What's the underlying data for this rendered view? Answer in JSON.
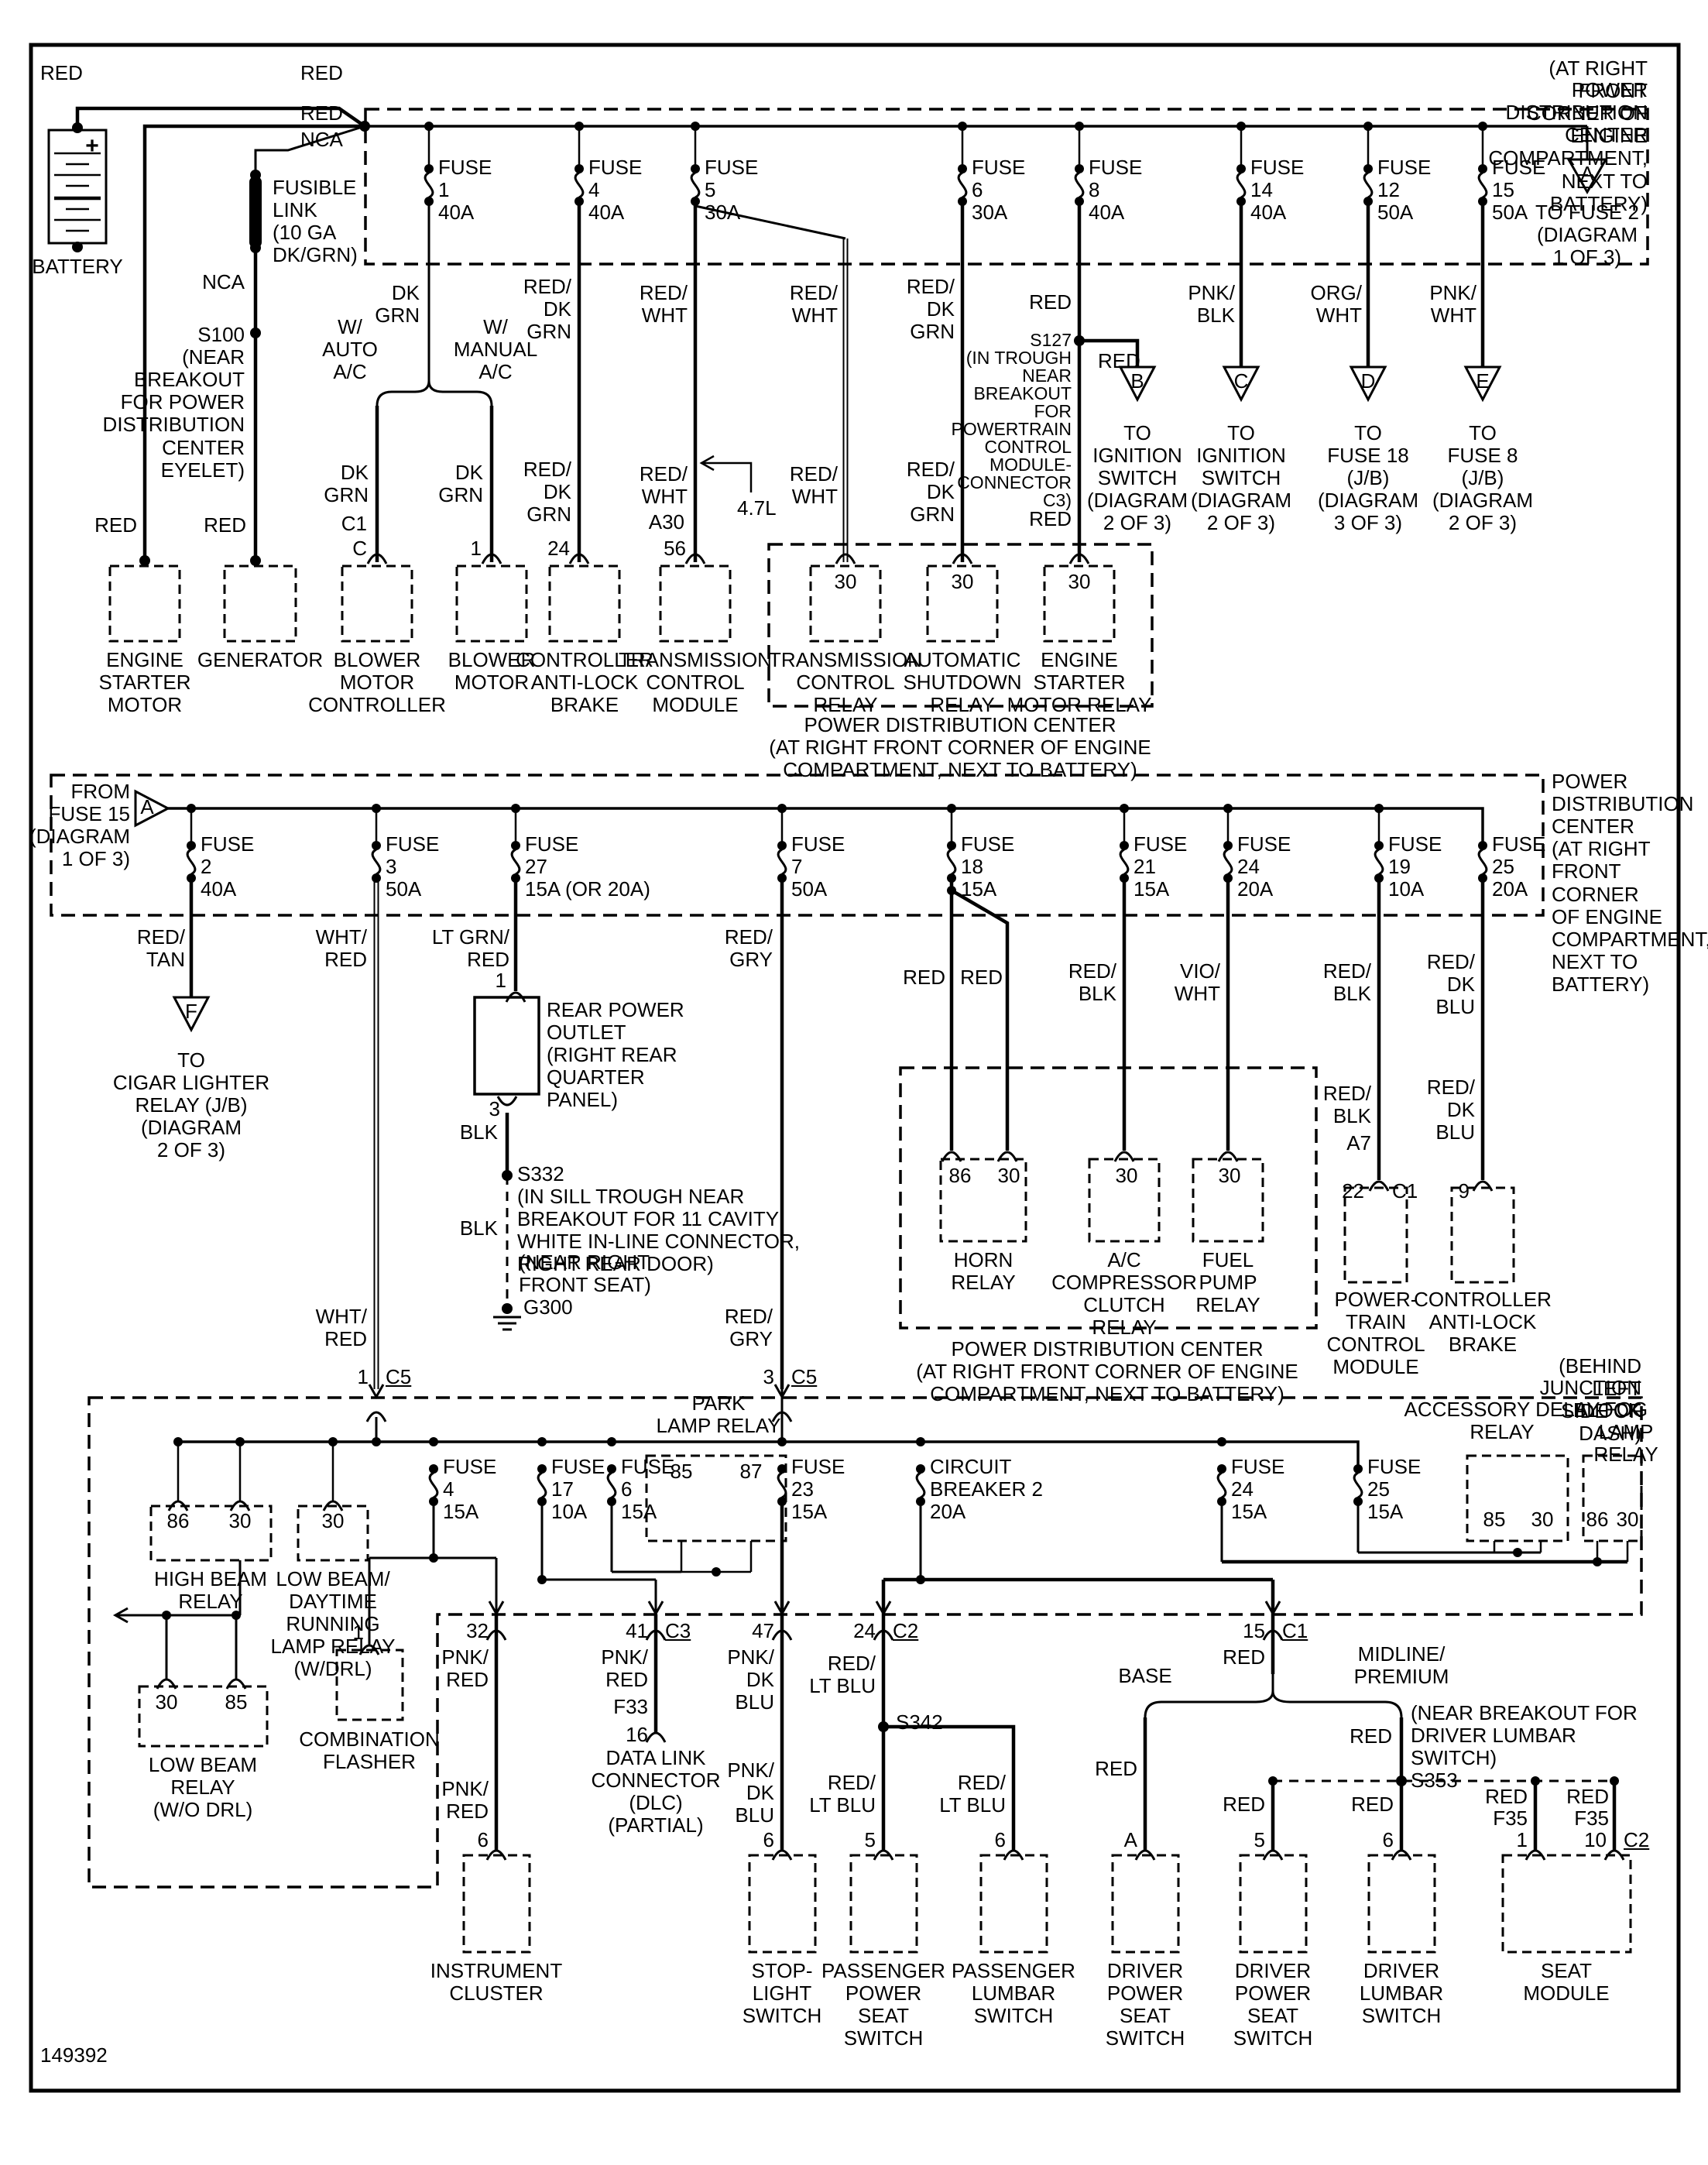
{
  "doc": {
    "id": "149392"
  },
  "s1": {
    "loc": "(AT RIGHT FRONT CORNER OF ENGINE COMPARTMENT, NEXT TO BATTERY)",
    "title": "POWER DISTRIBUTION CENTER",
    "red": "RED",
    "nca": "NCA",
    "battery": "BATTERY",
    "plus": "+",
    "fusible": "FUSIBLE\nLINK\n(10 GA\nDK/GRN)",
    "s100": "S100\n(NEAR\nBREAKOUT\nFOR POWER\nDISTRIBUTION\nCENTER\nEYELET)",
    "fuses": [
      "FUSE\n1\n40A",
      "FUSE\n4\n40A",
      "FUSE\n5\n30A",
      "FUSE\n6\n30A",
      "FUSE\n8\n40A",
      "FUSE\n14\n40A",
      "FUSE\n12\n50A",
      "FUSE\n15\n50A"
    ],
    "tri_a": "A",
    "to_fuse2": "TO FUSE 2\n(DIAGRAM\n1 OF 3)",
    "dkgrn": "DK\nGRN",
    "w_auto": "W/\nAUTO\nA/C",
    "w_manual": "W/\nMANUAL\nA/C",
    "c1": "C1",
    "pin_c": "C",
    "pin_1": "1",
    "reddkgrn": "RED/\nDK\nGRN",
    "pin_24": "24",
    "redwht": "RED/\nWHT",
    "a30": "A30",
    "pin_56": "56",
    "l47": "4.7L",
    "s127": "S127\n(IN TROUGH\nNEAR\nBREAKOUT\nFOR\nPOWERTRAIN\nCONTROL\nMODULE-\nCONNECTOR\nC3)",
    "pnkblk": "PNK/\nBLK",
    "orgwht": "ORG/\nWHT",
    "pnkwht": "PNK/\nWHT",
    "tri_b": "B",
    "tri_c": "C",
    "tri_d": "D",
    "tri_e": "E",
    "cap_ign": "TO\nIGNITION\nSWITCH\n(DIAGRAM\n2 OF 3)",
    "cap_d": "TO\nFUSE 18\n(J/B)\n(DIAGRAM\n3 OF 3)",
    "cap_e": "TO\nFUSE 8\n(J/B)\n(DIAGRAM\n2 OF 3)",
    "p30": "30",
    "c_esm": "ENGINE\nSTARTER\nMOTOR",
    "c_gen": "GENERATOR",
    "c_bmc": "BLOWER\nMOTOR\nCONTROLLER",
    "c_bm": "BLOWER\nMOTOR",
    "c_calb": "CONTROLLER\nANTI-LOCK\nBRAKE",
    "c_tcm": "TRANSMISSION\nCONTROL\nMODULE",
    "c_tcr": "TRANSMISSION\nCONTROL\nRELAY",
    "c_asr": "AUTOMATIC\nSHUTDOWN\nRELAY",
    "c_esmr": "ENGINE\nSTARTER\nMOTOR RELAY",
    "pdc2cap": "POWER DISTRIBUTION CENTER\n(AT RIGHT FRONT CORNER OF ENGINE\nCOMPARTMENT, NEXT TO BATTERY)"
  },
  "s2": {
    "from_fuse15": "FROM\nFUSE 15\n(DIAGRAM\n1 OF 3)",
    "tri_a": "A",
    "fuses": [
      "FUSE\n2\n40A",
      "FUSE\n3\n50A",
      "FUSE\n27\n15A (OR 20A)",
      "FUSE\n7\n50A",
      "FUSE\n18\n15A",
      "FUSE\n21\n15A",
      "FUSE\n24\n20A",
      "FUSE\n19\n10A",
      "FUSE\n25\n20A"
    ],
    "pdc_right": "POWER\nDISTRIBUTION\nCENTER\n(AT RIGHT\nFRONT CORNER\nOF ENGINE\nCOMPARTMENT,\nNEXT TO\nBATTERY)",
    "redtan": "RED/\nTAN",
    "tri_f": "F",
    "cap_f": "TO\nCIGAR LIGHTER\nRELAY (J/B)\n(DIAGRAM\n2 OF 3)",
    "whtred": "WHT/\nRED",
    "ltgrnred": "LT GRN/\nRED",
    "pin1": "1",
    "rpo": "REAR POWER\nOUTLET\n(RIGHT REAR\nQUARTER\nPANEL)",
    "pin3": "3",
    "blk": "BLK",
    "s332": "S332\n(IN SILL TROUGH NEAR\nBREAKOUT FOR 11 CAVITY\nWHITE IN-LINE CONNECTOR,\nRIGHT REAR DOOR)",
    "near_seat": "(NEAR RIGHT\nFRONT SEAT)",
    "g300": "G300",
    "redgry": "RED/\nGRY",
    "red": "RED",
    "redblk": "RED/\nBLK",
    "viowht": "VIO/\nWHT",
    "a7": "A7",
    "pin22": "22",
    "c1": "C1",
    "reddkblu": "RED/\nDK\nBLU",
    "pin9": "9",
    "p86": "86",
    "p30": "30",
    "horn": "HORN\nRELAY",
    "accr": "A/C\nCOMPRESSOR\nCLUTCH\nRELAY",
    "fpr": "FUEL\nPUMP\nRELAY",
    "pdc3cap": "POWER DISTRIBUTION CENTER\n(AT RIGHT FRONT CORNER OF ENGINE\nCOMPARTMENT, NEXT TO BATTERY)",
    "pcm": "POWER-\nTRAIN\nCONTROL\nMODULE",
    "calb": "CONTROLLER\nANTI-LOCK\nBRAKE"
  },
  "s3": {
    "loc": "(BEHIND LEFT SIDE OF DASH)",
    "title": "JUNCTION BLOCK",
    "pin1": "1",
    "pin3": "3",
    "c5": "C5",
    "park": "PARK\nLAMP RELAY",
    "fuses": [
      "FUSE\n4\n15A",
      "FUSE\n17\n10A",
      "FUSE\n6\n15A",
      "FUSE\n23\n15A",
      "FUSE\n24\n15A",
      "FUSE\n25\n15A"
    ],
    "cb2": "CIRCUIT\nBREAKER 2\n20A",
    "adr": "ACCESSORY DELAY\nRELAY",
    "flr": "FOG LAMP\nRELAY",
    "p85": "85",
    "p86": "86",
    "p87": "87",
    "p30": "30",
    "hbr": "HIGH BEAM\nRELAY",
    "lbdrl": "LOW BEAM/\nDAYTIME\nRUNNING\nLAMP RELAY\n(W/DRL)",
    "lbr": "LOW BEAM\nRELAY\n(W/O DRL)",
    "flasher_pin": "1",
    "flasher": "COMBINATION\nFLASHER"
  },
  "s4": {
    "p32": "32",
    "p41": "41",
    "c3": "C3",
    "p47": "47",
    "p24": "24",
    "c2": "C2",
    "p15": "15",
    "c1": "C1",
    "pnkred": "PNK/\nRED",
    "f33": "F33",
    "p16": "16",
    "dlc": "DATA LINK\nCONNECTOR\n(DLC)\n(PARTIAL)",
    "pnkdkblu": "PNK/\nDK\nBLU",
    "redltblu": "RED/\nLT BLU",
    "s342": "S342",
    "red": "RED",
    "base": "BASE",
    "midline": "MIDLINE/\nPREMIUM",
    "s353": "(NEAR BREAKOUT FOR\nDRIVER LUMBAR\nSWITCH)\nS353",
    "f35": "F35",
    "pin5": "5",
    "pin6": "6",
    "pinA": "A",
    "pin1": "1",
    "pin10": "10",
    "ic": "INSTRUMENT\nCLUSTER",
    "sls": "STOP-\nLIGHT\nSWITCH",
    "pps": "PASSENGER\nPOWER\nSEAT\nSWITCH",
    "pls": "PASSENGER\nLUMBAR\nSWITCH",
    "dpss": "DRIVER\nPOWER\nSEAT\nSWITCH",
    "dls": "DRIVER\nLUMBAR\nSWITCH",
    "sm": "SEAT\nMODULE"
  }
}
